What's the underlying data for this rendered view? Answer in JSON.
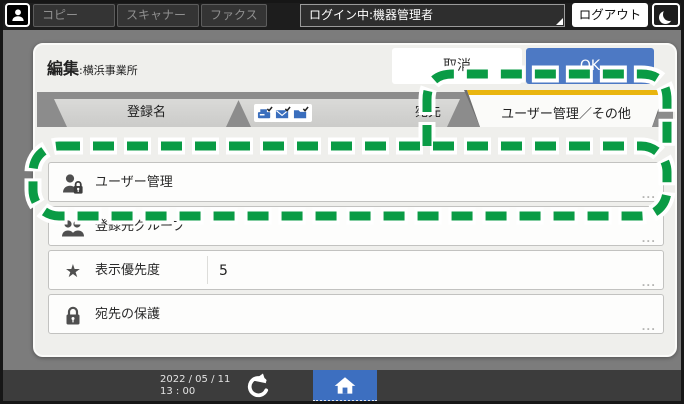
{
  "colors": {
    "accent_blue": "#4d79c4",
    "home_blue": "#3d6fc0",
    "tab_gold": "#e9b50f",
    "callout_green": "#0a9b45",
    "panel_bg": "#efefec",
    "tab_band": "#8c8c8c"
  },
  "top_bar": {
    "user_icon": "person-silhouette",
    "apps": {
      "copy": "コピー",
      "scanner": "スキャナー",
      "fax": "ファクス"
    },
    "login_status": "ログイン中:機器管理者",
    "logout": "ログアウト",
    "energy_saver_icon": "crescent-moon"
  },
  "editor": {
    "title": "編集",
    "target_name": ":横浜事業所",
    "cancel": "取消",
    "ok": "OK"
  },
  "tabs": {
    "registration_name": "登録名",
    "destination": "宛先",
    "destination_icons": [
      "fax-check",
      "email-check",
      "folder-check"
    ],
    "user_management_other": "ユーザー管理／その他"
  },
  "list": {
    "more": "...",
    "items": [
      {
        "label": "ユーザー管理",
        "icon": "user-lock"
      },
      {
        "label": "登録先グループ",
        "icon": "group"
      },
      {
        "label": "表示優先度",
        "icon": "star",
        "value": "5"
      },
      {
        "label": "宛先の保護",
        "icon": "lock"
      }
    ]
  },
  "footer": {
    "date": "2022 / 05 / 11",
    "time": "13 : 00",
    "back_icon": "undo-arrow",
    "home_icon": "home"
  },
  "annotation": {
    "shape": "green-dashed-callout",
    "highlights": [
      "ユーザー管理／その他 tab",
      "ユーザー管理 row"
    ]
  }
}
